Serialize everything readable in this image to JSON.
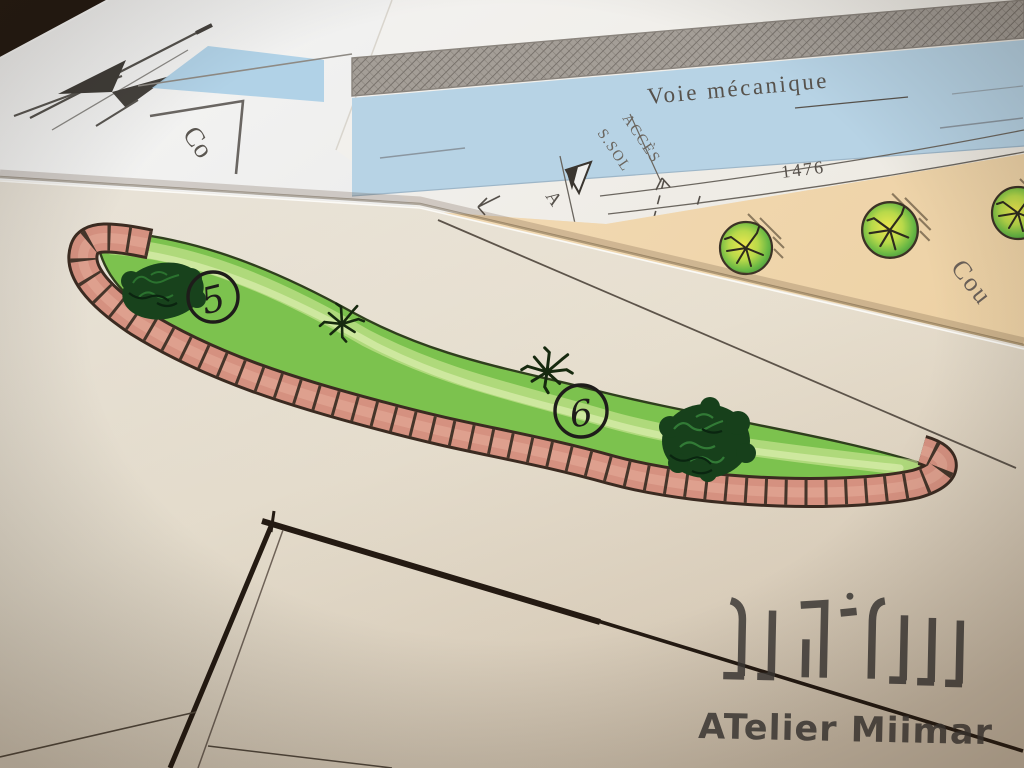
{
  "plan_sheet": {
    "road_label": "Voie mécanique",
    "access_label_line1": "ACCÈS",
    "access_label_line2": "S.SOL",
    "section_marker_label": "A",
    "dimension_value": "1476",
    "courtyard_label": "Cou",
    "corner_label": "Co"
  },
  "design_sheet": {
    "planting_labels": [
      "5",
      "6"
    ]
  },
  "watermark": {
    "studio_name": "ATelier Miimar"
  },
  "icons": {
    "compass": "compass-rose-icon",
    "tree": "tree-symbol-icon",
    "shrub": "shrub-symbol-icon",
    "plant": "plant-symbol-icon",
    "section_marker": "section-marker-icon",
    "logo": "atelier-logo-icon"
  },
  "colors": {
    "road_blue": "#b7d3e5",
    "hatch_gray": "#a49e97",
    "courtyard_peach": "#f0d6ad",
    "lawn_green": "#7cc24e",
    "brick_edge_pink": "#d59180",
    "ink": "#2b2218",
    "watermark_gray": "#3d3936"
  }
}
